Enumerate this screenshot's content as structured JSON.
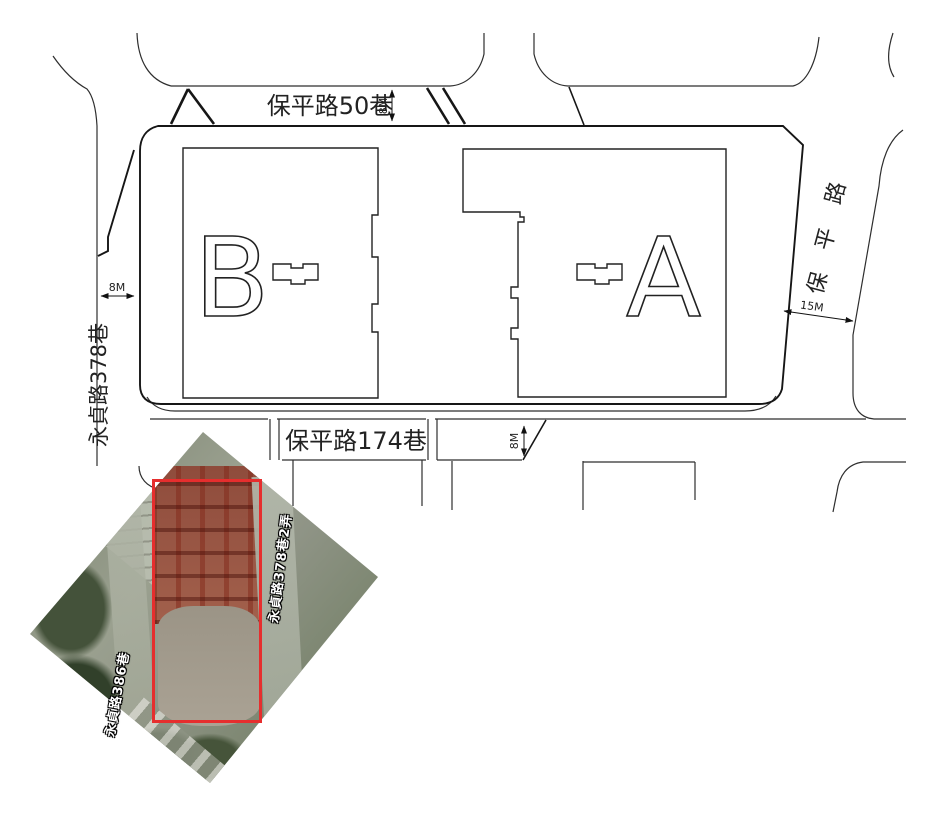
{
  "plan": {
    "roads": {
      "top": {
        "label": "保平路50巷",
        "width_dim": "8M"
      },
      "left": {
        "label": "永貞路378巷",
        "width_dim": "8M"
      },
      "bottom": {
        "label": "保平路174巷",
        "width_dim": "8M"
      },
      "right": {
        "label": "保平路",
        "chars": [
          "路",
          "平",
          "保"
        ],
        "width_dim": "15M"
      }
    },
    "buildings": [
      {
        "label": "B"
      },
      {
        "label": "A"
      }
    ]
  },
  "photo": {
    "labels": [
      {
        "text": "永貞路378巷2弄"
      },
      {
        "text": "永貞路386巷"
      }
    ],
    "highlight_color": "#e62e2e"
  },
  "colors": {
    "line_dark": "#161616",
    "line_light": "#2e2e2e",
    "background": "#ffffff"
  }
}
